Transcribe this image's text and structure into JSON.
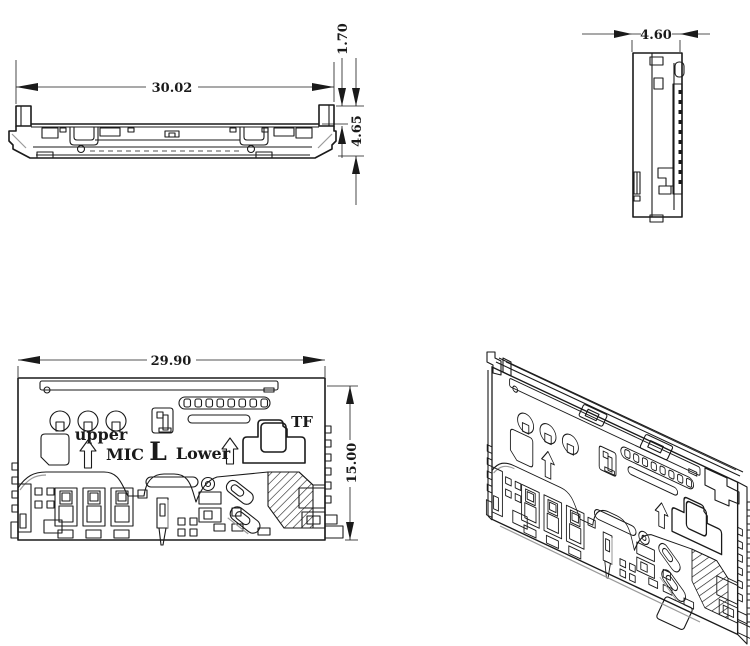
{
  "drawing": {
    "type": "engineering-drawing",
    "part": "dual-card-connector",
    "background": "#ffffff",
    "line_color": "#1a1a1a",
    "gray_accent_color": "#9a9a9a",
    "views": {
      "front": {
        "name": "front-elevation",
        "dims": {
          "width": "30.02",
          "tab_height": "1.70",
          "total_height": "4.65"
        }
      },
      "side": {
        "name": "side-elevation",
        "dims": {
          "depth": "4.60"
        }
      },
      "plan": {
        "name": "top-plan",
        "dims": {
          "width": "29.90",
          "height": "15.00"
        },
        "labels": {
          "upper": "upper",
          "mic": "MIC",
          "l": "L",
          "lower": "Lower",
          "tf": "TF"
        }
      },
      "iso": {
        "name": "isometric"
      }
    }
  }
}
